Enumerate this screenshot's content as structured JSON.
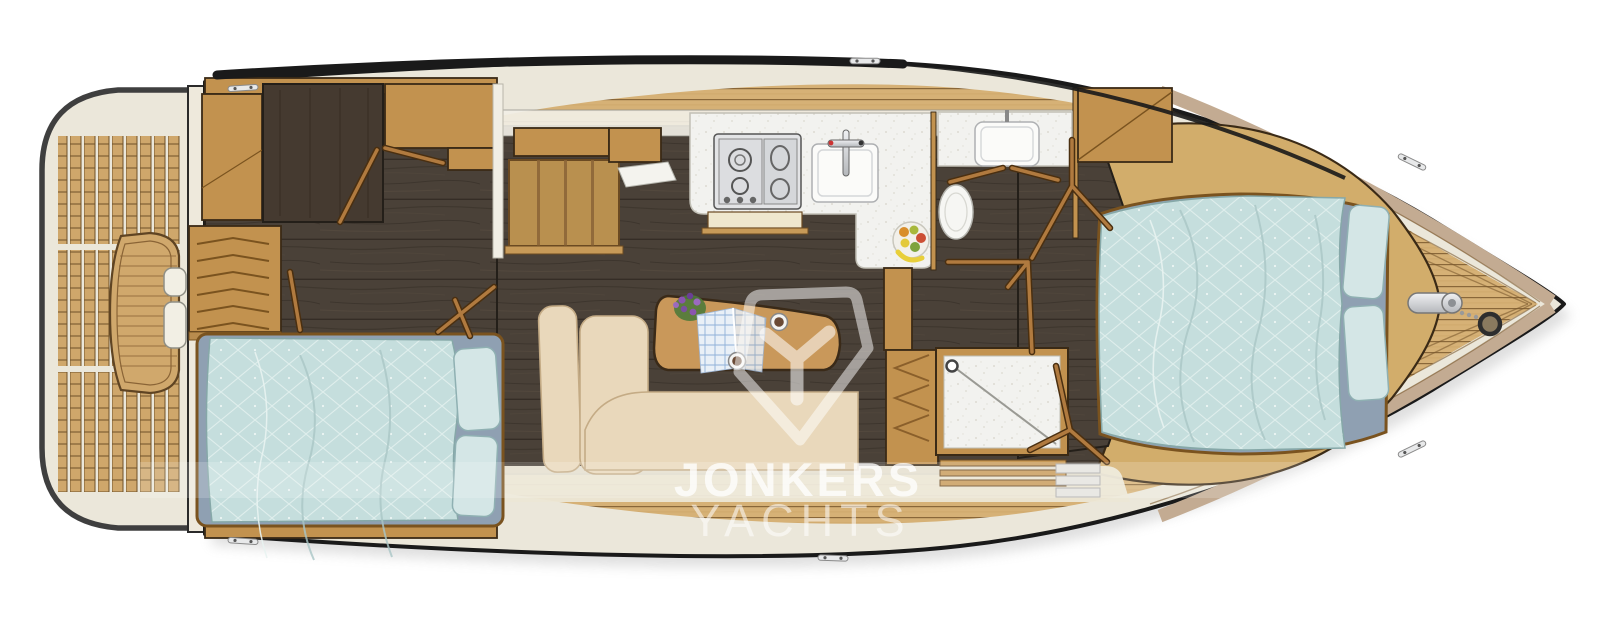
{
  "watermark": {
    "brand_line1": "JONKERS",
    "brand_line2": "YACHTS",
    "logo": "jonkers-y-shield-logo"
  },
  "palette": {
    "hull_line": "#1a1a1a",
    "gunwale": "#ebe7da",
    "teak_deck": "#d6b176",
    "teak_seam": "#7c5a2e",
    "cockpit_slat": "#cfa76b",
    "dark_floor": "#4a4138",
    "dark_panel": "#453a30",
    "maple": "#c2924f",
    "maple_light": "#d2ad6b",
    "wood_edge": "#3a2a16",
    "door_wood": "#b07a3f",
    "counter": "#f2f2ef",
    "steel": "#d7d8da",
    "duvet_blue": "#c5dedd",
    "duvet_edge": "#86a8a8",
    "mattress_blue": "#8fa0b2",
    "pillow_blue": "#d4e6e6",
    "settee": "#e9d8bb",
    "settee_edge": "#c4ab85",
    "roof_band": "#f2efe6",
    "bow_band": "#c3ab92",
    "watermark": "#ffffff"
  }
}
